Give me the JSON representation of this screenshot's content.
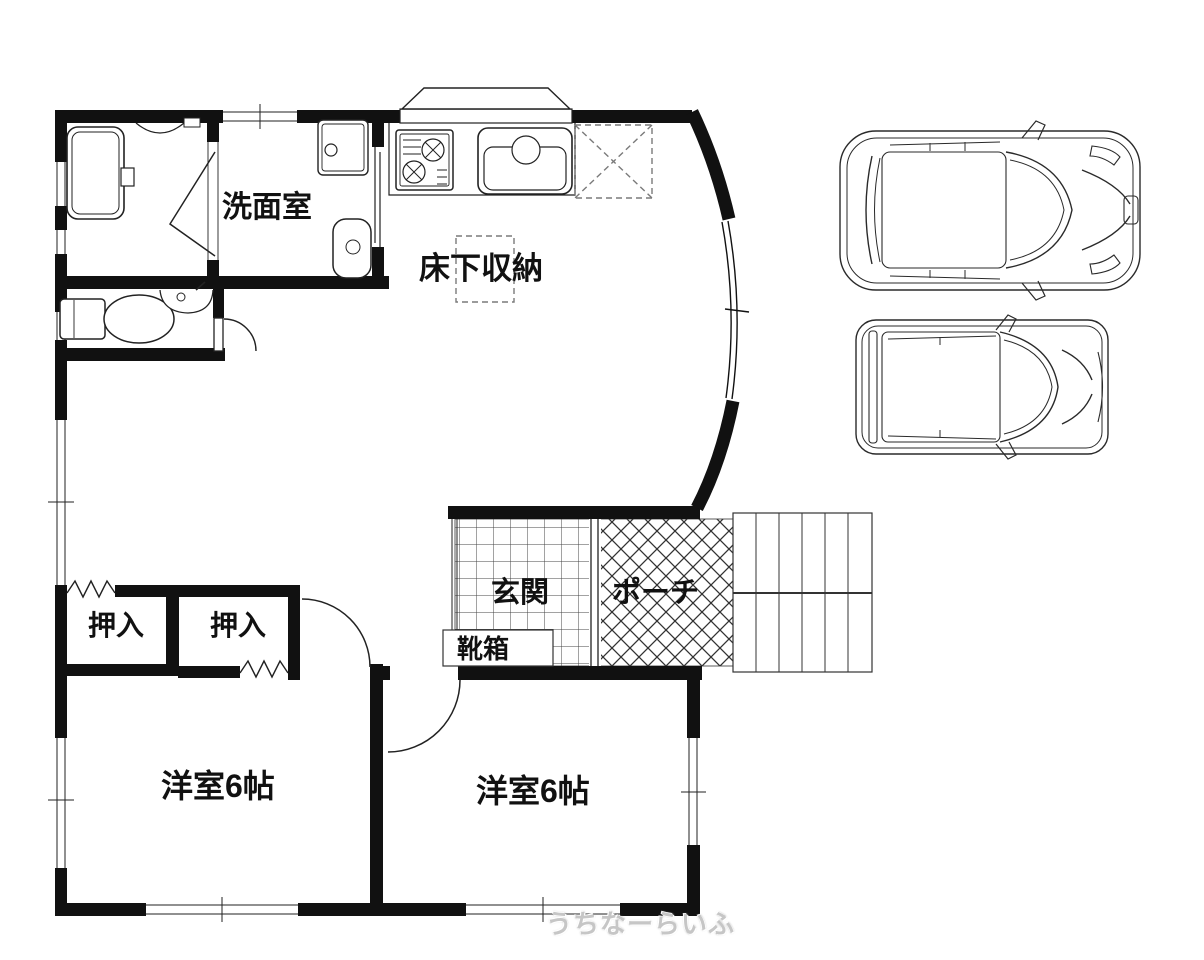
{
  "floor_plan": {
    "rooms": {
      "washroom": {
        "label": "洗面室"
      },
      "underfloor_storage": {
        "label": "床下収納"
      },
      "closet_left": {
        "label": "押入"
      },
      "closet_right": {
        "label": "押入"
      },
      "entrance": {
        "label": "玄関"
      },
      "porch": {
        "label": "ポーチ"
      },
      "shoe_box": {
        "label": "靴箱"
      },
      "bedroom_left": {
        "label": "洋室6帖"
      },
      "bedroom_right": {
        "label": "洋室6帖"
      }
    },
    "watermark": "うちなーらいふ",
    "colors": {
      "wall": "#111111",
      "line": "#222222",
      "dashed": "#7a7a7a",
      "background": "#ffffff",
      "watermark": "#c6c6c6"
    }
  }
}
